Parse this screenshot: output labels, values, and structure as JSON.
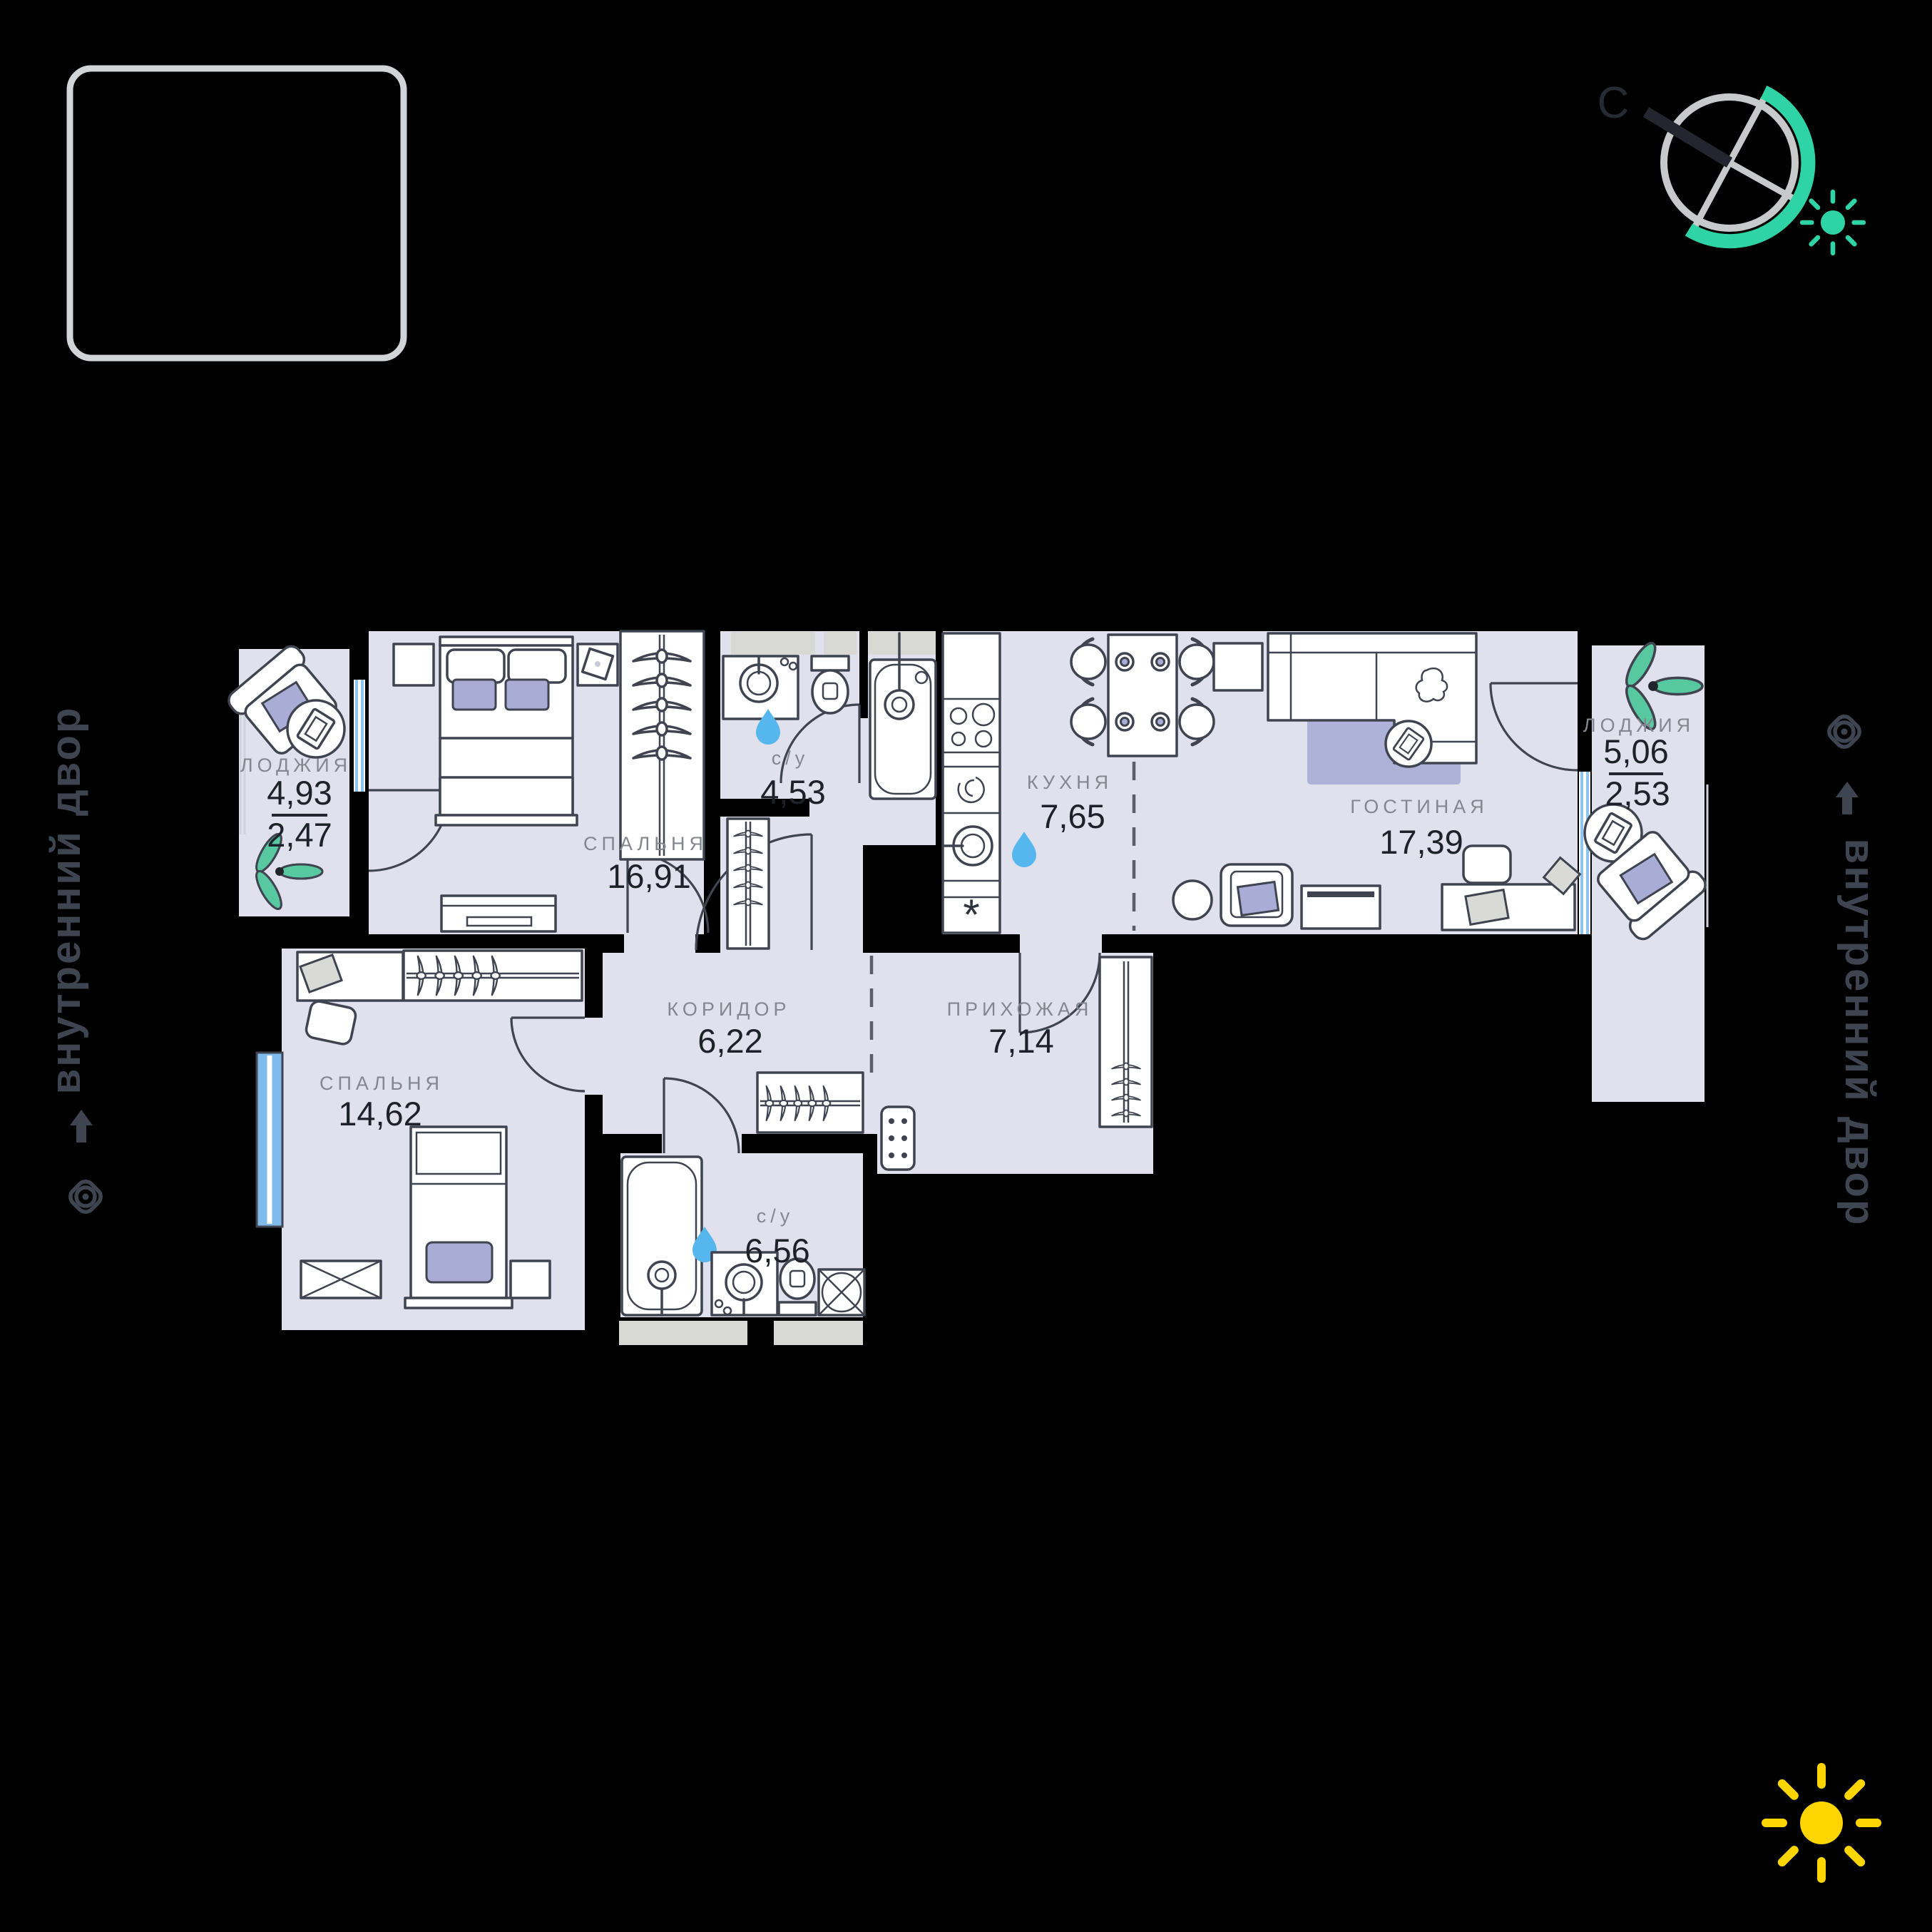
{
  "meta": {
    "type": "apartment-floor-plan",
    "background": "#000000"
  },
  "colors": {
    "floor": "#e0e1ec",
    "furniture_line": "#3f4450",
    "accent_lavender": "#a9add6",
    "rug_lavender": "#aeb1d8",
    "window_blue": "#7fbcec",
    "water_drop": "#56b7ef",
    "plant_teal": "#57c8a0",
    "compass_teal": "#2ed3a6",
    "sun_yellow": "#ffd500",
    "label_gray": "#84878f",
    "value_dark": "#1d2128",
    "courtyard_text": "#3e4450",
    "logo_border": "#d2d5d7"
  },
  "compass": {
    "north_label": "С"
  },
  "annotations": {
    "courtyard_left": "внутренний двор",
    "courtyard_right": "внутренний двор"
  },
  "icons": {
    "compass": "compass-icon",
    "sun_teal": "sun-icon",
    "sun_yellow": "sun-icon",
    "eye": "eye-icon",
    "arrow": "arrow-up-icon",
    "water_drop": "water-drop-icon",
    "plant": "plant-icon"
  },
  "rooms": {
    "loggia_left": {
      "name": "ЛОДЖИЯ",
      "area_total": "4,93",
      "area_reduced": "2,47"
    },
    "bedroom_1": {
      "name": "СПАЛЬНЯ",
      "area": "16,91"
    },
    "bathroom_1": {
      "name": "с/у",
      "area": "4,53"
    },
    "kitchen": {
      "name": "КУХНЯ",
      "area": "7,65"
    },
    "living_room": {
      "name": "ГОСТИНАЯ",
      "area": "17,39"
    },
    "loggia_right": {
      "name": "ЛОДЖИЯ",
      "area_total": "5,06",
      "area_reduced": "2,53"
    },
    "bedroom_2": {
      "name": "СПАЛЬНЯ",
      "area": "14,62"
    },
    "corridor": {
      "name": "КОРИДОР",
      "area": "6,22"
    },
    "hallway": {
      "name": "ПРИХОЖАЯ",
      "area": "7,14"
    },
    "bathroom_2": {
      "name": "с/у",
      "area": "6,56"
    }
  }
}
